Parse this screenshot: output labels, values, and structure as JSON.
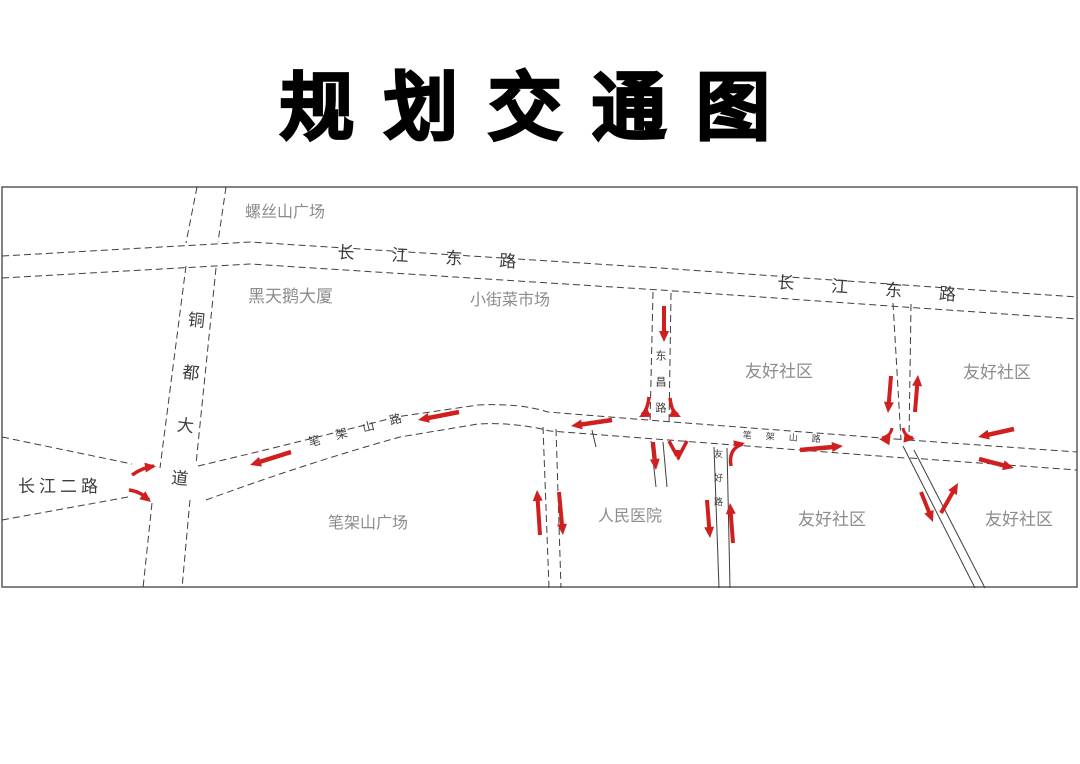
{
  "title": "规划交通图",
  "map": {
    "arrow_color": "#d01f1f",
    "labels": [
      {
        "name": "label-luosishan-plaza",
        "text": "螺丝山广场",
        "x": 245,
        "y": 205,
        "size": 16,
        "kind": "place"
      },
      {
        "name": "label-changjiang-east-road-west",
        "text": "长江东路",
        "x": 338,
        "y": 244,
        "size": 17,
        "kind": "road",
        "rotate": 3,
        "spacing": 37
      },
      {
        "name": "label-heitiane-building",
        "text": "黑天鹅大厦",
        "x": 248,
        "y": 288,
        "size": 17,
        "kind": "place"
      },
      {
        "name": "label-xiaojie-market",
        "text": "小街菜市场",
        "x": 470,
        "y": 293,
        "size": 16,
        "kind": "place"
      },
      {
        "name": "label-changjiang-east-road-east",
        "text": "长江东路",
        "x": 778,
        "y": 274,
        "size": 17,
        "kind": "road",
        "rotate": 4,
        "spacing": 37
      },
      {
        "name": "label-tongdu-avenue",
        "text": "铜都大道",
        "x": 187,
        "y": 310,
        "size": 17,
        "kind": "road",
        "vertical": true,
        "rotate": 6,
        "spacing": 36
      },
      {
        "name": "label-dongchang-road",
        "text": "东昌路",
        "x": 654,
        "y": 350,
        "size": 11,
        "kind": "road",
        "vertical": true,
        "spacing": 15
      },
      {
        "name": "label-youhao-community-1",
        "text": "友好社区",
        "x": 745,
        "y": 363,
        "size": 17,
        "kind": "place"
      },
      {
        "name": "label-youhao-community-2",
        "text": "友好社区",
        "x": 963,
        "y": 364,
        "size": 17,
        "kind": "place"
      },
      {
        "name": "label-changjiang-2-road",
        "text": "长江二路",
        "x": 18,
        "y": 478,
        "size": 17,
        "kind": "road",
        "spacing": 4
      },
      {
        "name": "label-bijiashan-road",
        "text": "笔架山路",
        "x": 307,
        "y": 437,
        "size": 12,
        "kind": "road",
        "rotate": -15,
        "spacing": 16
      },
      {
        "name": "label-bijiashan-plaza",
        "text": "笔架山广场",
        "x": 328,
        "y": 516,
        "size": 16,
        "kind": "place"
      },
      {
        "name": "label-renmin-hospital",
        "text": "人民医院",
        "x": 598,
        "y": 509,
        "size": 16,
        "kind": "place"
      },
      {
        "name": "label-youhao-community-3",
        "text": "友好社区",
        "x": 798,
        "y": 511,
        "size": 17,
        "kind": "place"
      },
      {
        "name": "label-youhao-community-4",
        "text": "友好社区",
        "x": 985,
        "y": 511,
        "size": 17,
        "kind": "place"
      },
      {
        "name": "label-bijiashan-road-east",
        "text": "笔架山路",
        "x": 743,
        "y": 431,
        "size": 9,
        "kind": "road",
        "rotate": 3,
        "spacing": 14
      },
      {
        "name": "label-youhao-road",
        "text": "友好路",
        "x": 713,
        "y": 449,
        "size": 9,
        "kind": "road",
        "vertical": true,
        "spacing": 15
      }
    ],
    "arrows": [
      {
        "x1": 664,
        "y1": 306,
        "x2": 664,
        "y2": 342,
        "w": 4
      },
      {
        "x1": 653,
        "y1": 442,
        "x2": 656,
        "y2": 470,
        "w": 4
      },
      {
        "d": "M669,441 L677,456 M687,441 L679,456 L678,459",
        "hx": 678,
        "hy": 461,
        "ha": 95,
        "w": 3.5
      },
      {
        "d": "M731,466 C729,454 733,447 743,444",
        "hx": 745,
        "hy": 443,
        "ha": -12,
        "w": 3.5
      },
      {
        "x1": 612,
        "y1": 420,
        "x2": 571,
        "y2": 426,
        "w": 4.5
      },
      {
        "x1": 459,
        "y1": 412,
        "x2": 418,
        "y2": 420,
        "w": 4.5
      },
      {
        "x1": 291,
        "y1": 452,
        "x2": 250,
        "y2": 465,
        "w": 4.5
      },
      {
        "d": "M132,475 C139,470 147,467 154,466",
        "hx": 156,
        "hy": 466,
        "ha": -8,
        "w": 3.5
      },
      {
        "d": "M129,490 C137,491 144,495 149,500",
        "hx": 151,
        "hy": 502,
        "ha": 38,
        "w": 3.5
      },
      {
        "x1": 800,
        "y1": 450,
        "x2": 843,
        "y2": 446,
        "w": 4.5
      },
      {
        "x1": 891,
        "y1": 376,
        "x2": 888,
        "y2": 413,
        "w": 4
      },
      {
        "x1": 915,
        "y1": 412,
        "x2": 918,
        "y2": 375,
        "w": 4
      },
      {
        "d": "M892,428 C891,434 887,437 882,438",
        "hx": 879,
        "hy": 439,
        "ha": 187,
        "w": 3
      },
      {
        "d": "M903,428 C904,434 908,437 913,438",
        "hx": 915,
        "hy": 439,
        "ha": 7,
        "w": 3
      },
      {
        "x1": 1014,
        "y1": 429,
        "x2": 978,
        "y2": 437,
        "w": 4.5
      },
      {
        "x1": 979,
        "y1": 459,
        "x2": 1014,
        "y2": 468,
        "w": 4.5
      },
      {
        "x1": 921,
        "y1": 492,
        "x2": 933,
        "y2": 522,
        "w": 4
      },
      {
        "x1": 941,
        "y1": 513,
        "x2": 958,
        "y2": 483,
        "w": 4
      },
      {
        "x1": 540,
        "y1": 535,
        "x2": 537,
        "y2": 490,
        "w": 4
      },
      {
        "x1": 559,
        "y1": 492,
        "x2": 563,
        "y2": 535,
        "w": 4
      },
      {
        "x1": 707,
        "y1": 500,
        "x2": 710,
        "y2": 538,
        "w": 4
      },
      {
        "x1": 733,
        "y1": 543,
        "x2": 730,
        "y2": 503,
        "w": 4
      },
      {
        "d": "M649,397 C648,406 646,411 642,415",
        "hx": 639,
        "hy": 417,
        "ha": 155,
        "w": 3.5
      },
      {
        "d": "M670,398 C671,407 673,412 678,415",
        "hx": 681,
        "hy": 417,
        "ha": 25,
        "w": 3.5
      }
    ]
  }
}
